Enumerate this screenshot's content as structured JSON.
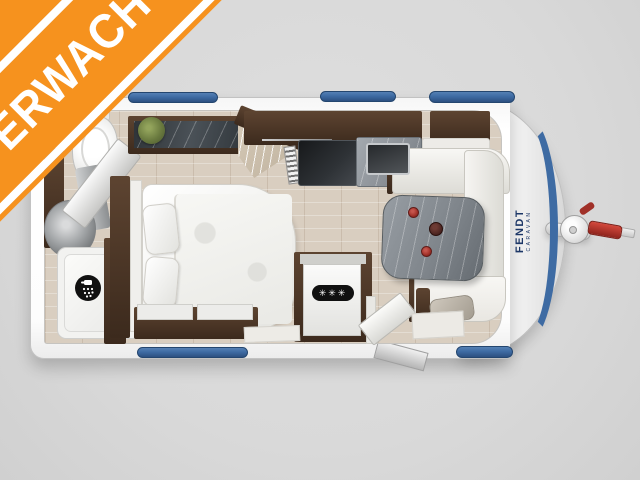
{
  "banner": {
    "text": "VERWACHT"
  },
  "brand": {
    "name": "FENDT",
    "subtitle": "CARAVAN"
  },
  "fridge": {
    "freezer_label": "✳✳✳"
  },
  "windows": {
    "top_count": 3,
    "bottom_count": 2
  },
  "colors": {
    "background": "#d9d9d9",
    "banner_orange": "#f6921e",
    "banner_text": "#ffffff",
    "accent_blue": "#3e6ba3",
    "brand_navy": "#1d3767",
    "wood_dark": "#3c2a1d",
    "wood_mid": "#5d4431",
    "floor_wood": "#d9cec0",
    "marble_gray": "#8e9399",
    "cup_red": "#a03028"
  }
}
